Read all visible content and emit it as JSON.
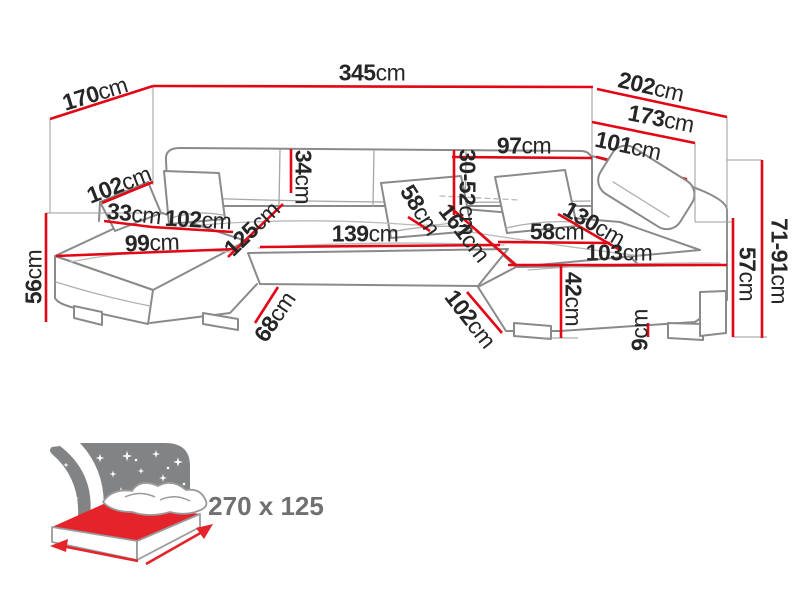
{
  "diagram": {
    "type": "corner-sofa-dimension-diagram",
    "unit": "cm",
    "colors": {
      "dimension_red": "#e30615",
      "sofa_outline_gray": "#8a8a8a",
      "construction_gray": "#9b9b9b",
      "icon_gray": "#818385",
      "mattress_red": "#e5232b",
      "label_text": "#262626",
      "sleeping_label_gray": "#6f7072"
    },
    "icons": {
      "sleep_icon": "sofa-bed-night-icon"
    }
  },
  "dims": [
    {
      "id": "left-side-total-depth",
      "value": "170",
      "unit": "cm"
    },
    {
      "id": "total-back-width",
      "value": "345",
      "unit": "cm"
    },
    {
      "id": "right-side-total-depth",
      "value": "202",
      "unit": "cm"
    },
    {
      "id": "right-side-inner-depth",
      "value": "173",
      "unit": "cm"
    },
    {
      "id": "right-back-depth",
      "value": "101",
      "unit": "cm"
    },
    {
      "id": "right-back-width",
      "value": "97",
      "unit": "cm"
    },
    {
      "id": "backrest-height-range",
      "value": "30-52",
      "unit": "cm"
    },
    {
      "id": "backrest-height",
      "value": "34",
      "unit": "cm"
    },
    {
      "id": "left-armrest-length",
      "value": "102",
      "unit": "cm"
    },
    {
      "id": "armrest-width",
      "value": "33",
      "unit": "cm"
    },
    {
      "id": "left-seat-width",
      "value": "102",
      "unit": "cm"
    },
    {
      "id": "left-chaise-front-width",
      "value": "99",
      "unit": "cm"
    },
    {
      "id": "front-height",
      "value": "56",
      "unit": "cm"
    },
    {
      "id": "left-chaise-seat-depth",
      "value": "125",
      "unit": "cm"
    },
    {
      "id": "middle-seat-width",
      "value": "139",
      "unit": "cm"
    },
    {
      "id": "middle-seat-depth",
      "value": "58",
      "unit": "cm"
    },
    {
      "id": "right-section-depth",
      "value": "161",
      "unit": "cm"
    },
    {
      "id": "right-seat-width",
      "value": "58",
      "unit": "cm"
    },
    {
      "id": "right-chaise-seat-length",
      "value": "130",
      "unit": "cm"
    },
    {
      "id": "right-chaise-front-length",
      "value": "103",
      "unit": "cm"
    },
    {
      "id": "seat-height",
      "value": "42",
      "unit": "cm"
    },
    {
      "id": "leg-height",
      "value": "9",
      "unit": "cm"
    },
    {
      "id": "armrest-height",
      "value": "57",
      "unit": "cm"
    },
    {
      "id": "total-height-range",
      "value": "71-91",
      "unit": "cm"
    },
    {
      "id": "middle-front-width",
      "value": "68",
      "unit": "cm"
    },
    {
      "id": "right-front-depth",
      "value": "102",
      "unit": "cm"
    }
  ],
  "sleeping_area": {
    "label": "270 x 125",
    "width_cm": 270,
    "depth_cm": 125
  }
}
